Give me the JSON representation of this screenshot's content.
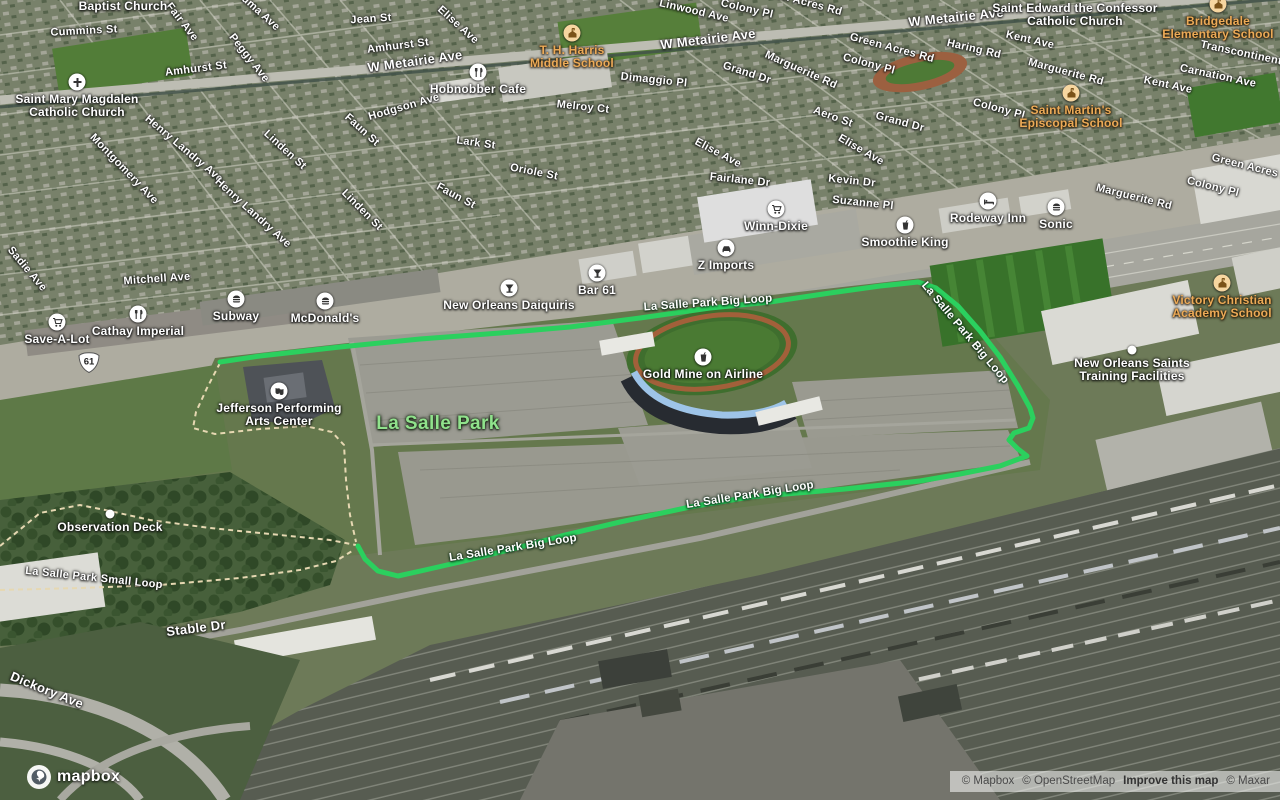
{
  "map": {
    "colors": {
      "route_green": "#2bd05e",
      "trail_tan": "#e6d8b2",
      "school_label": "#ecaa57",
      "park_label": "#90e28c"
    },
    "park_label": {
      "text": "La Salle Park",
      "x": 438,
      "y": 424
    },
    "shield": {
      "text": "61",
      "x": 89,
      "y": 363
    },
    "route": {
      "name": "La Salle Park Big Loop",
      "points": [
        [
          220,
          362
        ],
        [
          260,
          356
        ],
        [
          340,
          347
        ],
        [
          420,
          339
        ],
        [
          500,
          333
        ],
        [
          570,
          327
        ],
        [
          640,
          318
        ],
        [
          710,
          308
        ],
        [
          770,
          302
        ],
        [
          830,
          293
        ],
        [
          880,
          286
        ],
        [
          918,
          282
        ],
        [
          936,
          288
        ],
        [
          958,
          306
        ],
        [
          980,
          331
        ],
        [
          1000,
          357
        ],
        [
          1018,
          386
        ],
        [
          1030,
          408
        ],
        [
          1033,
          418
        ],
        [
          1029,
          428
        ],
        [
          1014,
          433
        ],
        [
          1009,
          440
        ],
        [
          1018,
          449
        ],
        [
          1027,
          456
        ],
        [
          1000,
          466
        ],
        [
          960,
          474
        ],
        [
          920,
          481
        ],
        [
          845,
          489
        ],
        [
          750,
          497
        ],
        [
          690,
          507
        ],
        [
          620,
          522
        ],
        [
          565,
          535
        ],
        [
          513,
          549
        ],
        [
          460,
          562
        ],
        [
          425,
          570
        ],
        [
          398,
          576
        ],
        [
          378,
          571
        ],
        [
          365,
          559
        ],
        [
          358,
          546
        ]
      ]
    },
    "trails": [
      {
        "name": "observation-deck-trail",
        "points": [
          [
            0,
            546
          ],
          [
            40,
            513
          ],
          [
            80,
            505
          ],
          [
            110,
            511
          ],
          [
            150,
            520
          ],
          [
            210,
            528
          ],
          [
            270,
            534
          ],
          [
            330,
            540
          ],
          [
            356,
            545
          ]
        ]
      },
      {
        "name": "small-loop-trail",
        "points": [
          [
            0,
            590
          ],
          [
            80,
            588
          ],
          [
            160,
            585
          ],
          [
            240,
            578
          ],
          [
            300,
            570
          ],
          [
            336,
            561
          ],
          [
            352,
            551
          ]
        ]
      },
      {
        "name": "jpac-trail",
        "points": [
          [
            220,
            363
          ],
          [
            207,
            388
          ],
          [
            196,
            412
          ],
          [
            193,
            428
          ],
          [
            215,
            434
          ],
          [
            260,
            429
          ],
          [
            305,
            426
          ],
          [
            332,
            432
          ],
          [
            344,
            445
          ],
          [
            346,
            480
          ],
          [
            350,
            515
          ],
          [
            356,
            542
          ]
        ]
      }
    ],
    "route_labels": [
      {
        "text": "La Salle Park Big Loop",
        "x": 708,
        "y": 303,
        "r": -4
      },
      {
        "text": "La Salle Park Big Loop",
        "x": 965,
        "y": 333,
        "r": 50
      },
      {
        "text": "La Salle Park Big Loop",
        "x": 750,
        "y": 495,
        "r": -9
      },
      {
        "text": "La Salle Park Big Loop",
        "x": 513,
        "y": 548,
        "r": -9
      }
    ],
    "streets": [
      {
        "t": "Cummins St",
        "x": 84,
        "y": 31,
        "r": -3
      },
      {
        "t": "Fair Ave",
        "x": 182,
        "y": 22,
        "r": 52
      },
      {
        "t": "Houma Ave",
        "x": 255,
        "y": 8,
        "r": 42
      },
      {
        "t": "Peggy Ave",
        "x": 249,
        "y": 58,
        "r": 52
      },
      {
        "t": "Jean St",
        "x": 371,
        "y": 19,
        "r": -4
      },
      {
        "t": "Amhurst St",
        "x": 196,
        "y": 69,
        "r": -7
      },
      {
        "t": "Amhurst St",
        "x": 398,
        "y": 46,
        "r": -7
      },
      {
        "t": "W Metairie Ave",
        "x": 415,
        "y": 61,
        "r": -8,
        "s": "lg"
      },
      {
        "t": "W Metairie Ave",
        "x": 708,
        "y": 39,
        "r": -7,
        "s": "lg"
      },
      {
        "t": "W Metairie Ave",
        "x": 956,
        "y": 17,
        "r": -6,
        "s": "lg"
      },
      {
        "t": "Linwood Ave",
        "x": 694,
        "y": 11,
        "r": 13
      },
      {
        "t": "Colony Pl",
        "x": 747,
        "y": 9,
        "r": 13
      },
      {
        "t": "Green Acres Rd",
        "x": 800,
        "y": 1,
        "r": 15
      },
      {
        "t": "Green Acres Rd",
        "x": 892,
        "y": 48,
        "r": 15
      },
      {
        "t": "Colony Pl",
        "x": 869,
        "y": 64,
        "r": 15
      },
      {
        "t": "Haring Rd",
        "x": 974,
        "y": 49,
        "r": 13
      },
      {
        "t": "Kent Ave",
        "x": 1030,
        "y": 40,
        "r": 13
      },
      {
        "t": "Transcontinental",
        "x": 1246,
        "y": 54,
        "r": 12
      },
      {
        "t": "Carnation Ave",
        "x": 1218,
        "y": 76,
        "r": 12
      },
      {
        "t": "Kent Ave",
        "x": 1168,
        "y": 85,
        "r": 12
      },
      {
        "t": "Marguerite Rd",
        "x": 801,
        "y": 70,
        "r": 24
      },
      {
        "t": "Grand Dr",
        "x": 747,
        "y": 73,
        "r": 18
      },
      {
        "t": "Grand Dr",
        "x": 900,
        "y": 122,
        "r": 15
      },
      {
        "t": "Marguerite Rd",
        "x": 1066,
        "y": 72,
        "r": 15
      },
      {
        "t": "Colony Pl",
        "x": 999,
        "y": 109,
        "r": 15
      },
      {
        "t": "Aero St",
        "x": 833,
        "y": 117,
        "r": 20
      },
      {
        "t": "Elise Ave",
        "x": 458,
        "y": 25,
        "r": 42
      },
      {
        "t": "Elise Ave",
        "x": 718,
        "y": 153,
        "r": 28
      },
      {
        "t": "Elise Ave",
        "x": 861,
        "y": 150,
        "r": 30
      },
      {
        "t": "Marguerite Rd",
        "x": 1134,
        "y": 197,
        "r": 14
      },
      {
        "t": "Green Acres Rd",
        "x": 1254,
        "y": 168,
        "r": 14
      },
      {
        "t": "Colony Pl",
        "x": 1213,
        "y": 187,
        "r": 14
      },
      {
        "t": "Fairlane Dr",
        "x": 740,
        "y": 180,
        "r": 6
      },
      {
        "t": "Kevin Dr",
        "x": 852,
        "y": 181,
        "r": 6
      },
      {
        "t": "Suzanne Pl",
        "x": 863,
        "y": 203,
        "r": 6
      },
      {
        "t": "Dimaggio Pl",
        "x": 654,
        "y": 80,
        "r": 6
      },
      {
        "t": "Melroy Ct",
        "x": 583,
        "y": 107,
        "r": 6
      },
      {
        "t": "Lark St",
        "x": 476,
        "y": 143,
        "r": 8
      },
      {
        "t": "Oriole St",
        "x": 534,
        "y": 172,
        "r": 11
      },
      {
        "t": "Faun St",
        "x": 362,
        "y": 130,
        "r": 42
      },
      {
        "t": "Faun St",
        "x": 456,
        "y": 196,
        "r": 28
      },
      {
        "t": "Linden St",
        "x": 285,
        "y": 150,
        "r": 42
      },
      {
        "t": "Linden St",
        "x": 362,
        "y": 210,
        "r": 45
      },
      {
        "t": "Henry Landry Ave",
        "x": 184,
        "y": 149,
        "r": 40
      },
      {
        "t": "Henry Landry Ave",
        "x": 253,
        "y": 213,
        "r": 42
      },
      {
        "t": "Montgomery Ave",
        "x": 124,
        "y": 169,
        "r": 46
      },
      {
        "t": "Hodgson Ave",
        "x": 404,
        "y": 107,
        "r": -16
      },
      {
        "t": "Sadie Ave",
        "x": 27,
        "y": 269,
        "r": 50
      },
      {
        "t": "Mitchell Ave",
        "x": 157,
        "y": 279,
        "r": -4
      },
      {
        "t": "Stable Dr",
        "x": 196,
        "y": 628,
        "r": -7,
        "s": "lg"
      },
      {
        "t": "Dickory Ave",
        "x": 47,
        "y": 690,
        "r": 22,
        "s": "lg"
      },
      {
        "t": "La Salle Park Small Loop",
        "x": 94,
        "y": 578,
        "r": 6
      }
    ],
    "pois": [
      {
        "name": "Baptist Church",
        "icon": null,
        "x": 123,
        "y": 6,
        "lines": [
          "Baptist Church"
        ]
      },
      {
        "name": "Saint Mary Magdalen Catholic Church",
        "icon": "cross",
        "x": 77,
        "y": 82,
        "lines": [
          "Saint Mary Magdalen",
          "Catholic Church"
        ]
      },
      {
        "name": "Saint Edward the Confessor Catholic Church",
        "icon": null,
        "x": 1075,
        "y": 8,
        "lines": [
          "Saint Edward the Confessor",
          "Catholic Church"
        ]
      },
      {
        "name": "T. H. Harris Middle School",
        "icon": "school",
        "x": 572,
        "y": 33,
        "lines": [
          "T. H. Harris",
          "Middle School"
        ],
        "cls": "school"
      },
      {
        "name": "Bridgedale Elementary School",
        "icon": "school",
        "x": 1218,
        "y": 4,
        "lines": [
          "Bridgedale",
          "Elementary School"
        ],
        "cls": "school"
      },
      {
        "name": "Saint Martin's Episcopal School",
        "icon": "school",
        "x": 1071,
        "y": 93,
        "lines": [
          "Saint Martin's",
          "Episcopal School"
        ],
        "cls": "school"
      },
      {
        "name": "Victory Christian Academy School",
        "icon": "school",
        "x": 1222,
        "y": 283,
        "lines": [
          "Victory Christian",
          "Academy School"
        ],
        "cls": "school"
      },
      {
        "name": "Hobnobber Cafe",
        "icon": "restaurant",
        "x": 478,
        "y": 72,
        "lines": [
          "Hobnobber Cafe"
        ]
      },
      {
        "name": "Save-A-Lot",
        "icon": "cart",
        "x": 57,
        "y": 322,
        "lines": [
          "Save-A-Lot"
        ]
      },
      {
        "name": "Cathay Imperial",
        "icon": "restaurant",
        "x": 138,
        "y": 314,
        "lines": [
          "Cathay Imperial"
        ]
      },
      {
        "name": "Subway",
        "icon": "burger",
        "x": 236,
        "y": 299,
        "lines": [
          "Subway"
        ]
      },
      {
        "name": "McDonald's",
        "icon": "burger",
        "x": 325,
        "y": 301,
        "lines": [
          "McDonald's"
        ]
      },
      {
        "name": "New Orleans Daiquiris",
        "icon": "cocktail",
        "x": 509,
        "y": 288,
        "lines": [
          "New Orleans Daiquiris"
        ]
      },
      {
        "name": "Bar 61",
        "icon": "cocktail",
        "x": 597,
        "y": 273,
        "lines": [
          "Bar 61"
        ]
      },
      {
        "name": "Z Imports",
        "icon": "car",
        "x": 726,
        "y": 248,
        "lines": [
          "Z Imports"
        ]
      },
      {
        "name": "Winn-Dixie",
        "icon": "cart",
        "x": 776,
        "y": 209,
        "lines": [
          "Winn-Dixie"
        ]
      },
      {
        "name": "Smoothie King",
        "icon": "cup",
        "x": 905,
        "y": 225,
        "lines": [
          "Smoothie King"
        ]
      },
      {
        "name": "Rodeway Inn",
        "icon": "bed",
        "x": 988,
        "y": 201,
        "lines": [
          "Rodeway Inn"
        ]
      },
      {
        "name": "Sonic",
        "icon": "burger",
        "x": 1056,
        "y": 207,
        "lines": [
          "Sonic"
        ]
      },
      {
        "name": "Gold Mine on Airline",
        "icon": "cup",
        "x": 703,
        "y": 357,
        "lines": [
          "Gold Mine on Airline"
        ]
      },
      {
        "name": "Jefferson Performing Arts Center",
        "icon": "theater",
        "x": 279,
        "y": 391,
        "lines": [
          "Jefferson Performing",
          "Arts Center"
        ]
      },
      {
        "name": "New Orleans Saints Training Facilities",
        "icon": "dot",
        "x": 1132,
        "y": 350,
        "lines": [
          "New Orleans Saints",
          "Training Facilities"
        ]
      },
      {
        "name": "Observation Deck",
        "icon": "dot",
        "x": 110,
        "y": 514,
        "lines": [
          "Observation Deck"
        ]
      }
    ],
    "attribution": {
      "items": [
        {
          "text": "© Mapbox",
          "bold": false
        },
        {
          "text": "© OpenStreetMap",
          "bold": false
        },
        {
          "text": "Improve this map",
          "bold": true
        },
        {
          "text": "© Maxar",
          "bold": false
        }
      ]
    },
    "logo_text": "mapbox"
  }
}
